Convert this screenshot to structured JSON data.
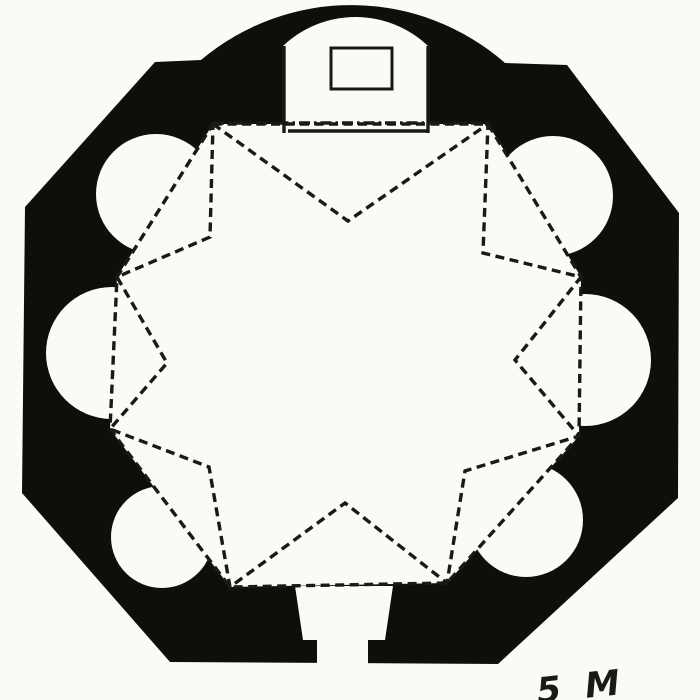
{
  "figure": {
    "signature": "5 M",
    "colors": {
      "paper": "#fbfaf7",
      "wall": "#100e0b",
      "ink": "#1b1914"
    },
    "canvas": {
      "w": 700,
      "h": 700
    },
    "outer_wall_path": [
      {
        "op": "M",
        "p": [
          155,
          62
        ]
      },
      {
        "op": "L",
        "p": [
          201,
          60
        ]
      },
      {
        "op": "A",
        "r": 233,
        "p": [
          505,
          63
        ]
      },
      {
        "op": "L",
        "p": [
          567,
          65
        ]
      },
      {
        "op": "L",
        "p": [
          679,
          213
        ]
      },
      {
        "op": "L",
        "p": [
          678,
          498
        ]
      },
      {
        "op": "L",
        "p": [
          498,
          664
        ]
      },
      {
        "op": "L",
        "p": [
          170,
          662
        ]
      },
      {
        "op": "L",
        "p": [
          22,
          493
        ]
      },
      {
        "op": "L",
        "p": [
          25,
          207
        ]
      },
      {
        "op": "Z"
      }
    ],
    "inner_octagon": [
      [
        213,
        124
      ],
      [
        488,
        124
      ],
      [
        581,
        277
      ],
      [
        579,
        436
      ],
      [
        447,
        583
      ],
      [
        230,
        587
      ],
      [
        110,
        429
      ],
      [
        117,
        277
      ]
    ],
    "star_notches": [
      [
        348,
        221
      ],
      [
        483,
        253
      ],
      [
        515,
        360
      ],
      [
        465,
        471
      ],
      [
        345,
        503
      ],
      [
        209,
        467
      ],
      [
        167,
        363
      ],
      [
        210,
        237
      ]
    ],
    "niches": [
      {
        "cx": 156,
        "cy": 194,
        "r": 60
      },
      {
        "cx": 112,
        "cy": 353,
        "r": 66
      },
      {
        "cx": 162,
        "cy": 537,
        "r": 51
      },
      {
        "cx": 526,
        "cy": 520,
        "r": 57
      },
      {
        "cx": 585,
        "cy": 360,
        "r": 66
      },
      {
        "cx": 553,
        "cy": 196,
        "r": 60
      }
    ],
    "apse_path": [
      {
        "op": "M",
        "p": [
          283,
          133
        ]
      },
      {
        "op": "L",
        "p": [
          283,
          46
        ]
      },
      {
        "op": "A",
        "r": 105,
        "p": [
          428,
          46
        ]
      },
      {
        "op": "L",
        "p": [
          428,
          133
        ]
      },
      {
        "op": "Z"
      }
    ],
    "apse_jamb_left": {
      "x": 284,
      "y1": 46,
      "y2": 133
    },
    "apse_jamb_right": {
      "x": 428,
      "y1": 46,
      "y2": 133
    },
    "apse_threshold": {
      "x1": 288,
      "y1": 131,
      "x2": 428,
      "y2": 131
    },
    "altar": {
      "x": 331,
      "y": 48,
      "w": 61,
      "h": 41
    },
    "entrance_passage": [
      [
        295,
        586
      ],
      [
        393,
        586
      ],
      [
        385,
        640
      ],
      [
        368,
        640
      ],
      [
        368,
        672
      ],
      [
        317,
        672
      ],
      [
        317,
        640
      ],
      [
        303,
        640
      ]
    ],
    "line_style": {
      "solid_width": 3.4,
      "dash_width": 3.4,
      "dash_pattern": "9 5.5",
      "dash_pattern_top": "11 4 2.5 4"
    },
    "signature_pos": {
      "x": 538,
      "y": 703,
      "size": 35,
      "rotate": -6,
      "spacing": 6
    }
  }
}
